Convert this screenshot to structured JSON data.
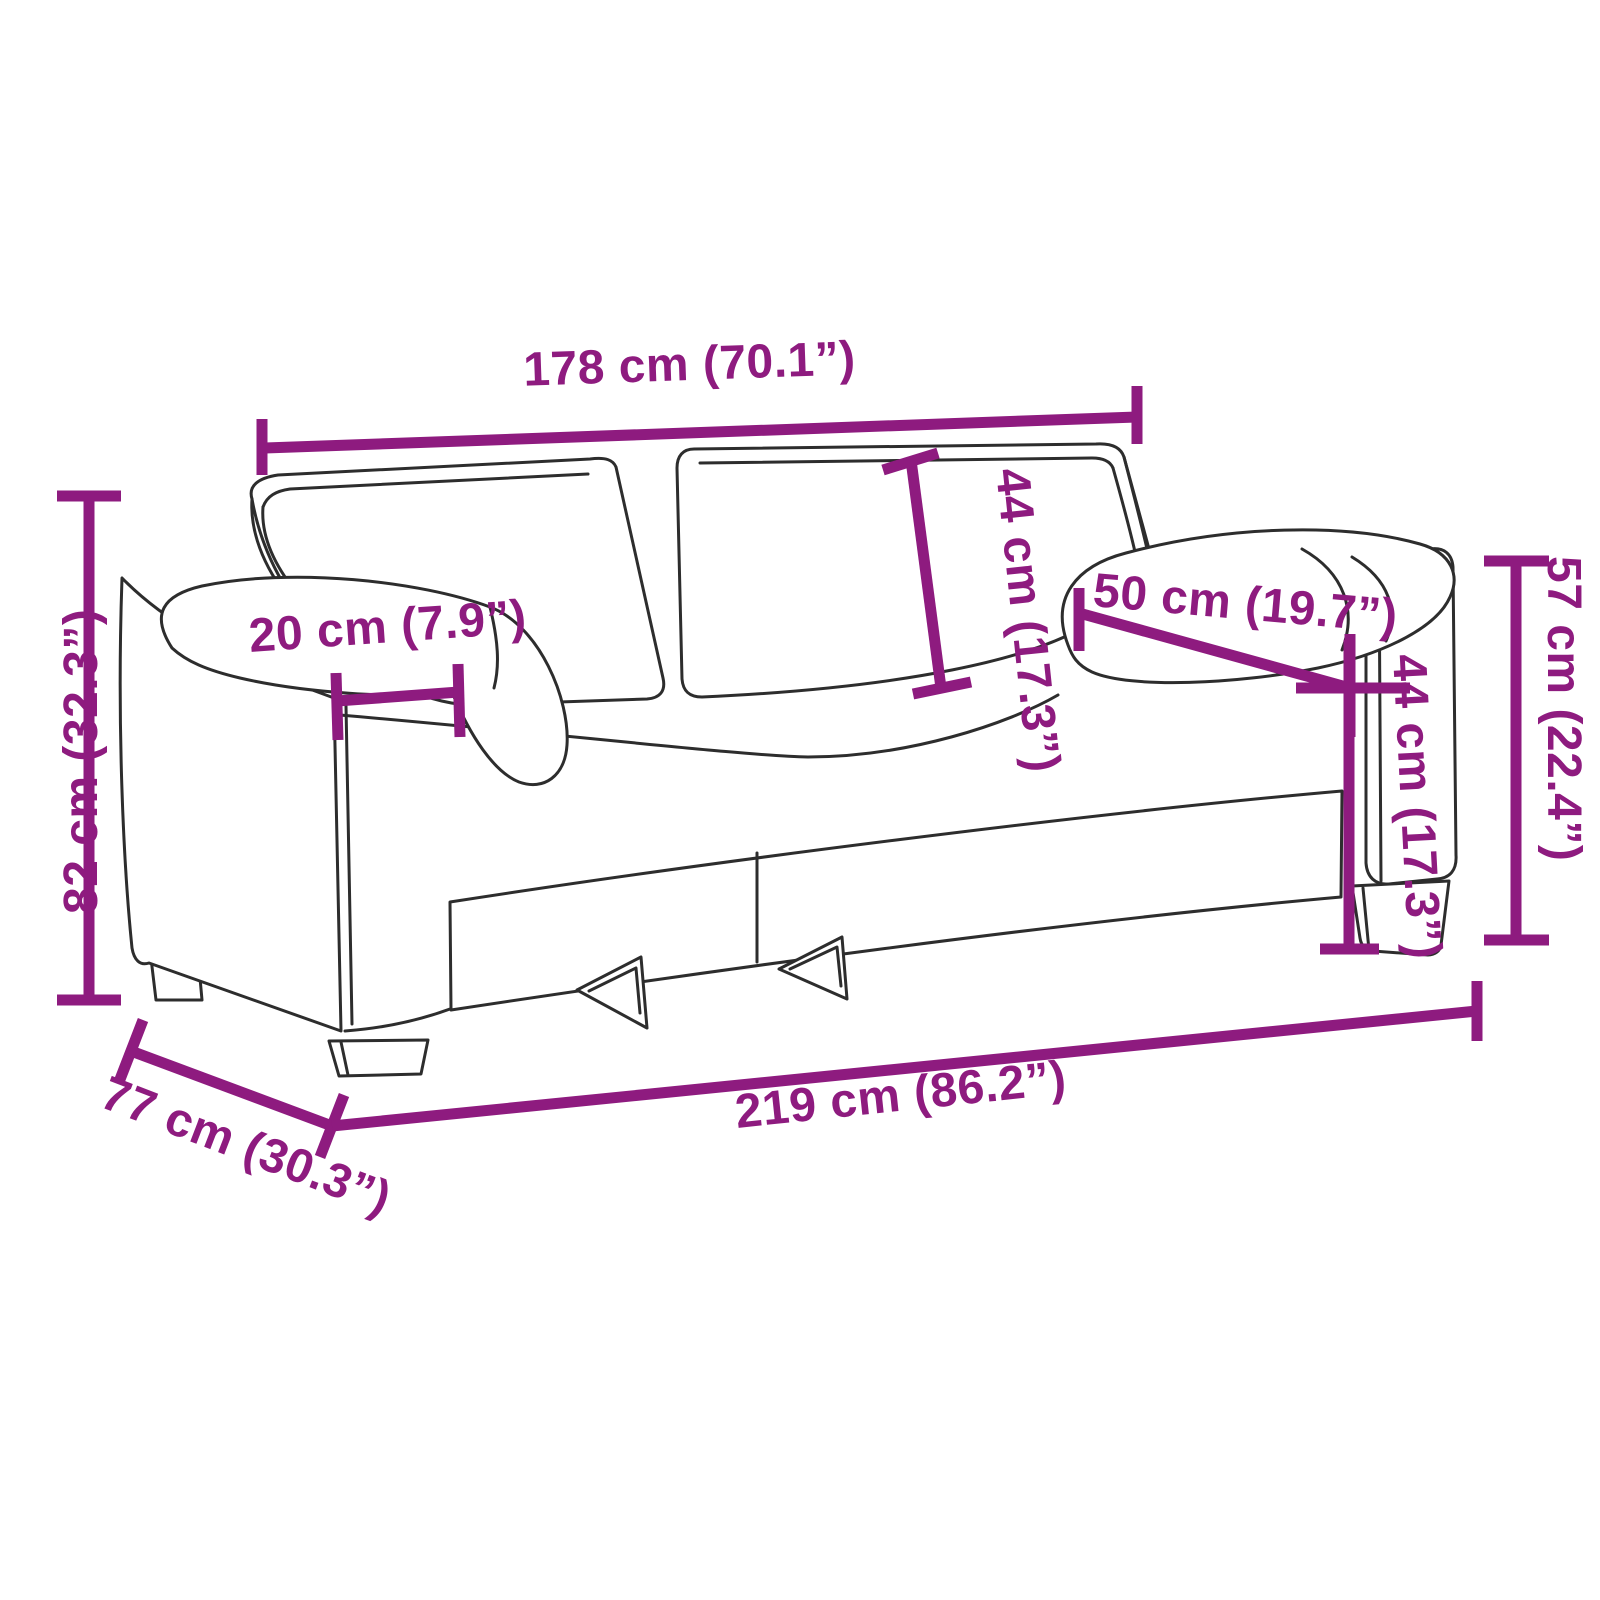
{
  "diagram": {
    "subject": "sofa-dimension-diagram",
    "description": "Line drawing of a two-seat sofa annotated with measurement lines",
    "background_color": "#ffffff",
    "accent_color": "#8E1B7F",
    "line_art_color": "#2d2d2d"
  },
  "dimensions": [
    {
      "id": "back_width",
      "label": "178 cm (70.1”)",
      "cm": "178",
      "inches": "70.1"
    },
    {
      "id": "backrest_height",
      "label": "44 cm (17.3”)",
      "cm": "44",
      "inches": "17.3"
    },
    {
      "id": "armrest_length",
      "label": "50 cm (19.7”)",
      "cm": "50",
      "inches": "19.7"
    },
    {
      "id": "armrest_width",
      "label": "20 cm (7.9”)",
      "cm": "20",
      "inches": "7.9"
    },
    {
      "id": "seat_height",
      "label": "44 cm (17.3”)",
      "cm": "44",
      "inches": "17.3"
    },
    {
      "id": "arm_height",
      "label": "57 cm (22.4”)",
      "cm": "57",
      "inches": "22.4"
    },
    {
      "id": "total_height",
      "label": "82 cm (32.3”)",
      "cm": "82",
      "inches": "32.3"
    },
    {
      "id": "depth",
      "label": "77 cm (30.3”)",
      "cm": "77",
      "inches": "30.3"
    },
    {
      "id": "total_width",
      "label": "219 cm (86.2”)",
      "cm": "219",
      "inches": "86.2"
    }
  ]
}
